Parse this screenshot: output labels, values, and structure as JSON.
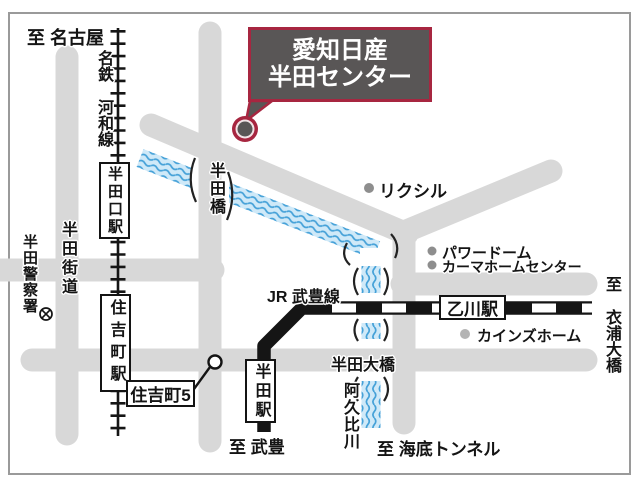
{
  "map": {
    "title_callout": {
      "line1": "愛知日産",
      "line2": "半田センター"
    },
    "destinations": {
      "to_nagoya": "至 名古屋",
      "to_taketoyo": "至 武豊",
      "to_kinuura_ohashi": "至 衣浦大橋",
      "to_kaitei_tunnel": "至 海底トンネル"
    },
    "railways": {
      "meitetsu_kowa_line": "名鉄 河和線",
      "jr_taketoyo_line": "JR 武豊線"
    },
    "stations": {
      "handaguchi": "半田口駅",
      "sumiyoshicho": "住吉町駅",
      "handa": "半田駅",
      "otsukawa": "乙川駅"
    },
    "roads": {
      "handa_kaido": "半田街道"
    },
    "bridges": {
      "handabashi": "半田橋",
      "handa_ohashi": "半田大橋"
    },
    "river": {
      "agui_river": "阿久比川"
    },
    "pois": {
      "police": "半田警察署",
      "lixil": "リクシル",
      "power_dome": "パワードーム",
      "kama_home_center": "カーマホームセンター",
      "cainz_home": "カインズホーム"
    },
    "intersections": {
      "sumiyoshicho5": "住吉町5"
    },
    "colors": {
      "accent_red": "#a72640",
      "callout_gray": "#595656",
      "road_gray": "#d8d8d8",
      "river_blue": "#cfe9f8",
      "wave_blue": "#45a1d8",
      "rail_black": "#151515"
    }
  }
}
